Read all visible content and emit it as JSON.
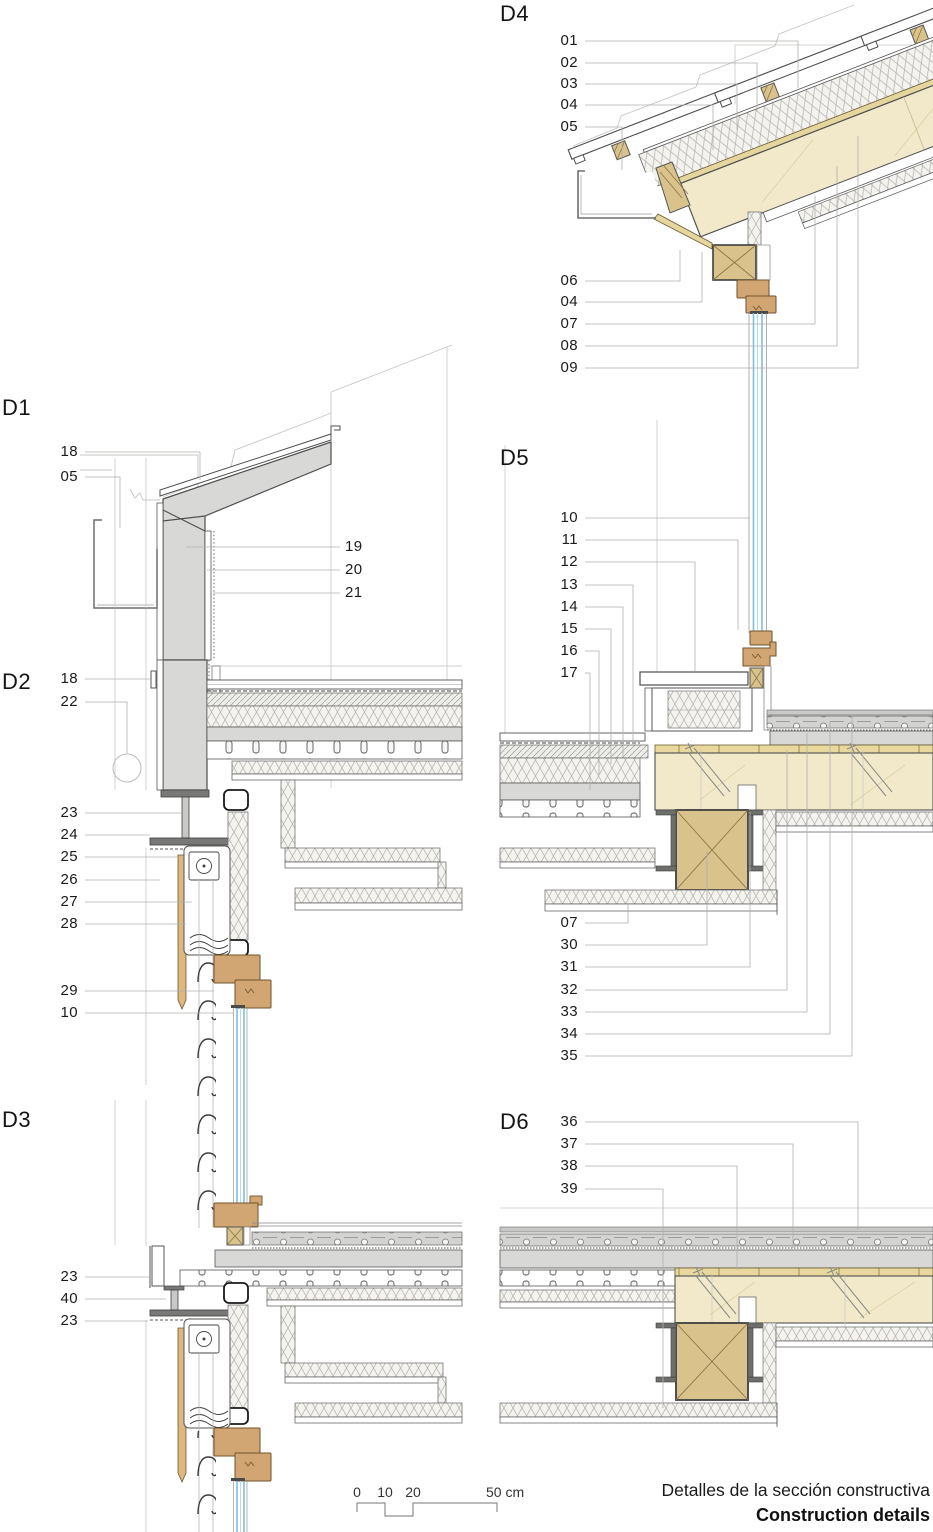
{
  "page": {
    "title_es": "Detalles de la sección constructiva",
    "title_en": "Construction details"
  },
  "scale_bar": {
    "tick_0": "0",
    "tick_10": "10",
    "tick_20": "20",
    "end_label": "50 cm"
  },
  "details": {
    "d1": {
      "label": "D1",
      "callouts_left": [
        "18",
        "05"
      ],
      "callouts_right": [
        "19",
        "20",
        "21"
      ]
    },
    "d2": {
      "label": "D2",
      "callouts": [
        "18",
        "22",
        "23",
        "24",
        "25",
        "26",
        "27",
        "28",
        "29",
        "10"
      ]
    },
    "d3": {
      "label": "D3",
      "callouts": [
        "23",
        "40",
        "23"
      ]
    },
    "d4": {
      "label": "D4",
      "callouts_top": [
        "01",
        "02",
        "03",
        "04",
        "05"
      ],
      "callouts_bottom": [
        "06",
        "04",
        "07",
        "08",
        "09"
      ]
    },
    "d5": {
      "label": "D5",
      "callouts_top": [
        "10",
        "11",
        "12",
        "13",
        "14",
        "15",
        "16",
        "17"
      ],
      "callouts_bottom": [
        "07",
        "30",
        "31",
        "32",
        "33",
        "34",
        "35"
      ]
    },
    "d6": {
      "label": "D6",
      "callouts": [
        "36",
        "37",
        "38",
        "39"
      ]
    }
  },
  "colors": {
    "line_dark": "#3f3f3f",
    "leader_gray": "#b0b0ae",
    "panel_gray": "#d8d8d6",
    "steel_gray": "#787876",
    "timber_cream": "#f1e9ca",
    "timber_tan": "#e5d69e",
    "beam_tan": "#d9c28b",
    "frame_brown": "#d2a672",
    "glazing_blue": "#7cc0e2",
    "insulation_bg": "#f4f3f0"
  }
}
